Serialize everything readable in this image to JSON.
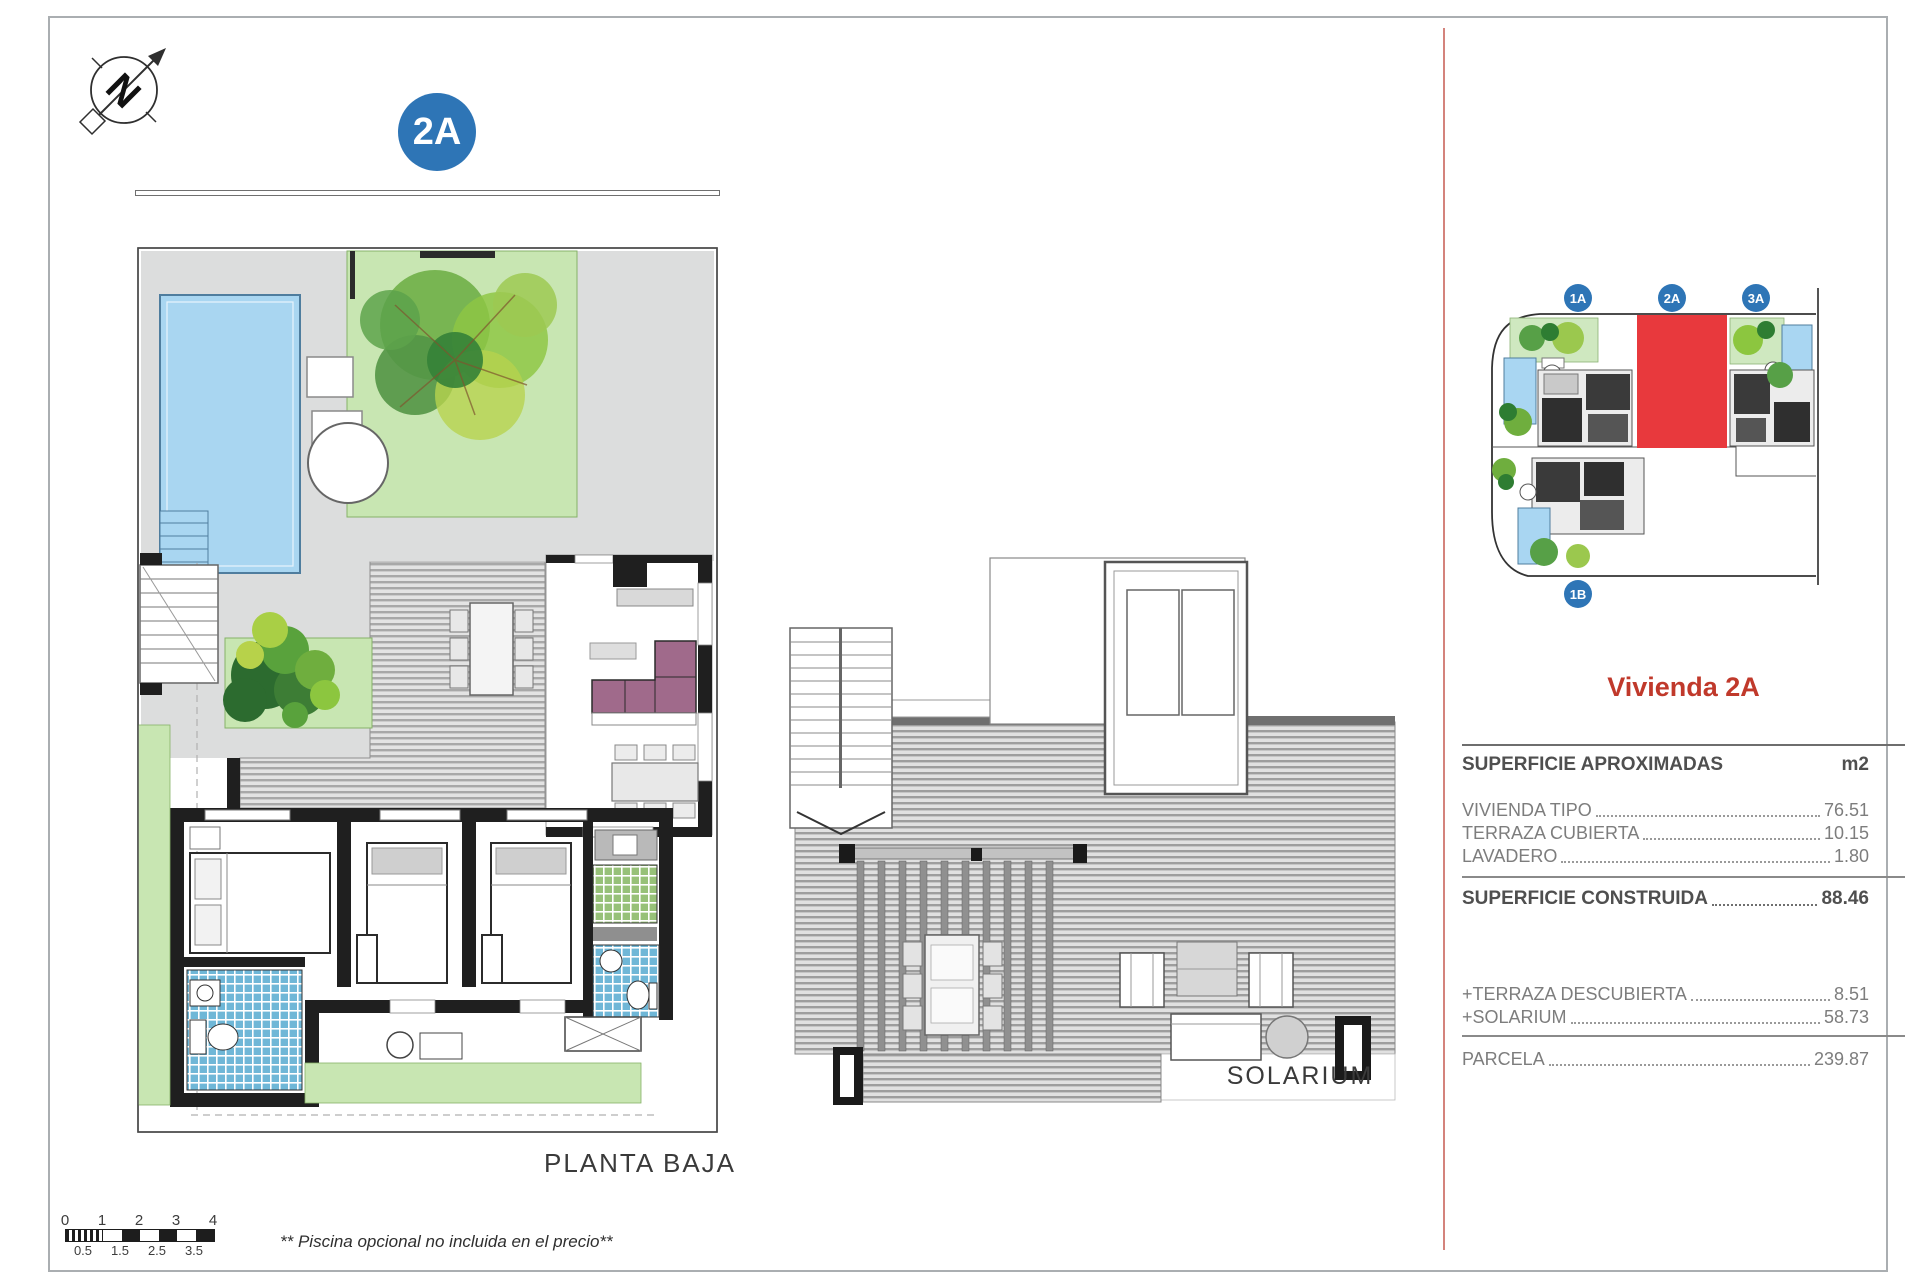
{
  "page": {
    "badge": "2A",
    "plan_label": "PLANTA BAJA",
    "solarium_label": "SOLARIUM",
    "footnote": "** Piscina opcional no incluida en el precio**",
    "compass_letter": "N"
  },
  "scale_bar": {
    "top_labels": [
      "0",
      "1",
      "2",
      "3",
      "4"
    ],
    "bottom_labels": [
      "0.5",
      "1.5",
      "2.5",
      "3.5"
    ]
  },
  "site_plan": {
    "badges": [
      "1A",
      "2A",
      "3A",
      "1B"
    ],
    "badge_color": "#2e75b6",
    "highlight_color": "#e8393d"
  },
  "panel": {
    "title": "Vivienda 2A",
    "title_color": "#c0392b",
    "table": {
      "header_label": "SUPERFICIE APROXIMADAS",
      "header_unit": "m2",
      "rows": [
        {
          "label": "VIVIENDA TIPO",
          "value": "76.51"
        },
        {
          "label": "TERRAZA CUBIERTA",
          "value": "10.15"
        },
        {
          "label": "LAVADERO",
          "value": "1.80"
        }
      ],
      "total_label": "SUPERFICIE CONSTRUIDA",
      "total_value": "88.46",
      "extras": [
        {
          "label": "+TERRAZA DESCUBIERTA",
          "value": "8.51"
        },
        {
          "label": "+SOLARIUM",
          "value": "58.73"
        }
      ],
      "parcela_label": "PARCELA",
      "parcela_value": "239.87"
    }
  }
}
